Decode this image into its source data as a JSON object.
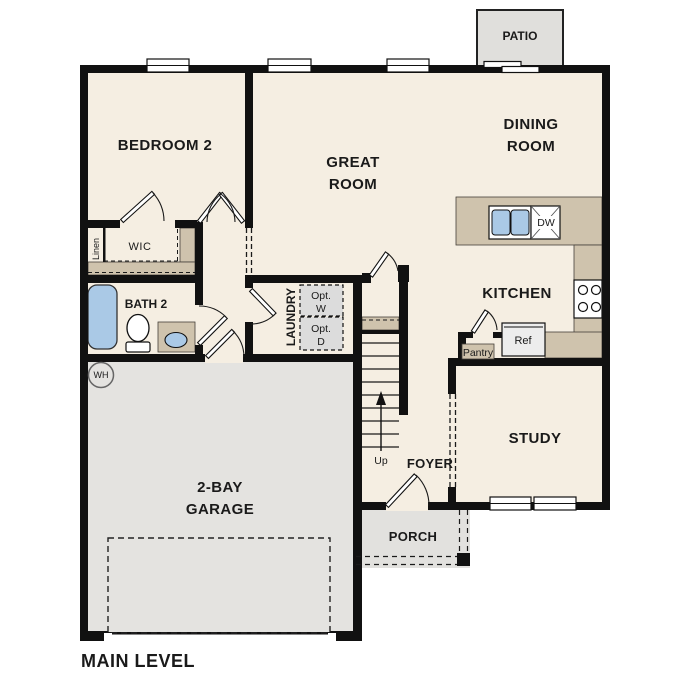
{
  "title": "MAIN LEVEL",
  "colors": {
    "floor": "#f5eee2",
    "counter": "#cfc3ad",
    "garage": "#e4e3e0",
    "porch": "#e2e1de",
    "patio": "#e0dfdc",
    "fixture_blue": "#aac9e6",
    "appliance": "#ededed",
    "optbox": "#dcdcdc",
    "wall": "#111111"
  },
  "rooms": {
    "bedroom2": "BEDROOM 2",
    "great_l1": "GREAT",
    "great_l2": "ROOM",
    "dining_l1": "DINING",
    "dining_l2": "ROOM",
    "kitchen": "KITCHEN",
    "study": "STUDY",
    "foyer": "FOYER",
    "laundry": "LAUNDRY",
    "bath2": "BATH 2",
    "garage_l1": "2-BAY",
    "garage_l2": "GARAGE",
    "porch": "PORCH",
    "patio": "PATIO",
    "wic": "WIC",
    "linen": "Linen"
  },
  "fixtures": {
    "opt_w_l1": "Opt.",
    "opt_w_l2": "W",
    "opt_d_l1": "Opt.",
    "opt_d_l2": "D",
    "pantry": "Pantry",
    "ref": "Ref",
    "dw": "DW",
    "wh": "WH",
    "up": "Up"
  }
}
